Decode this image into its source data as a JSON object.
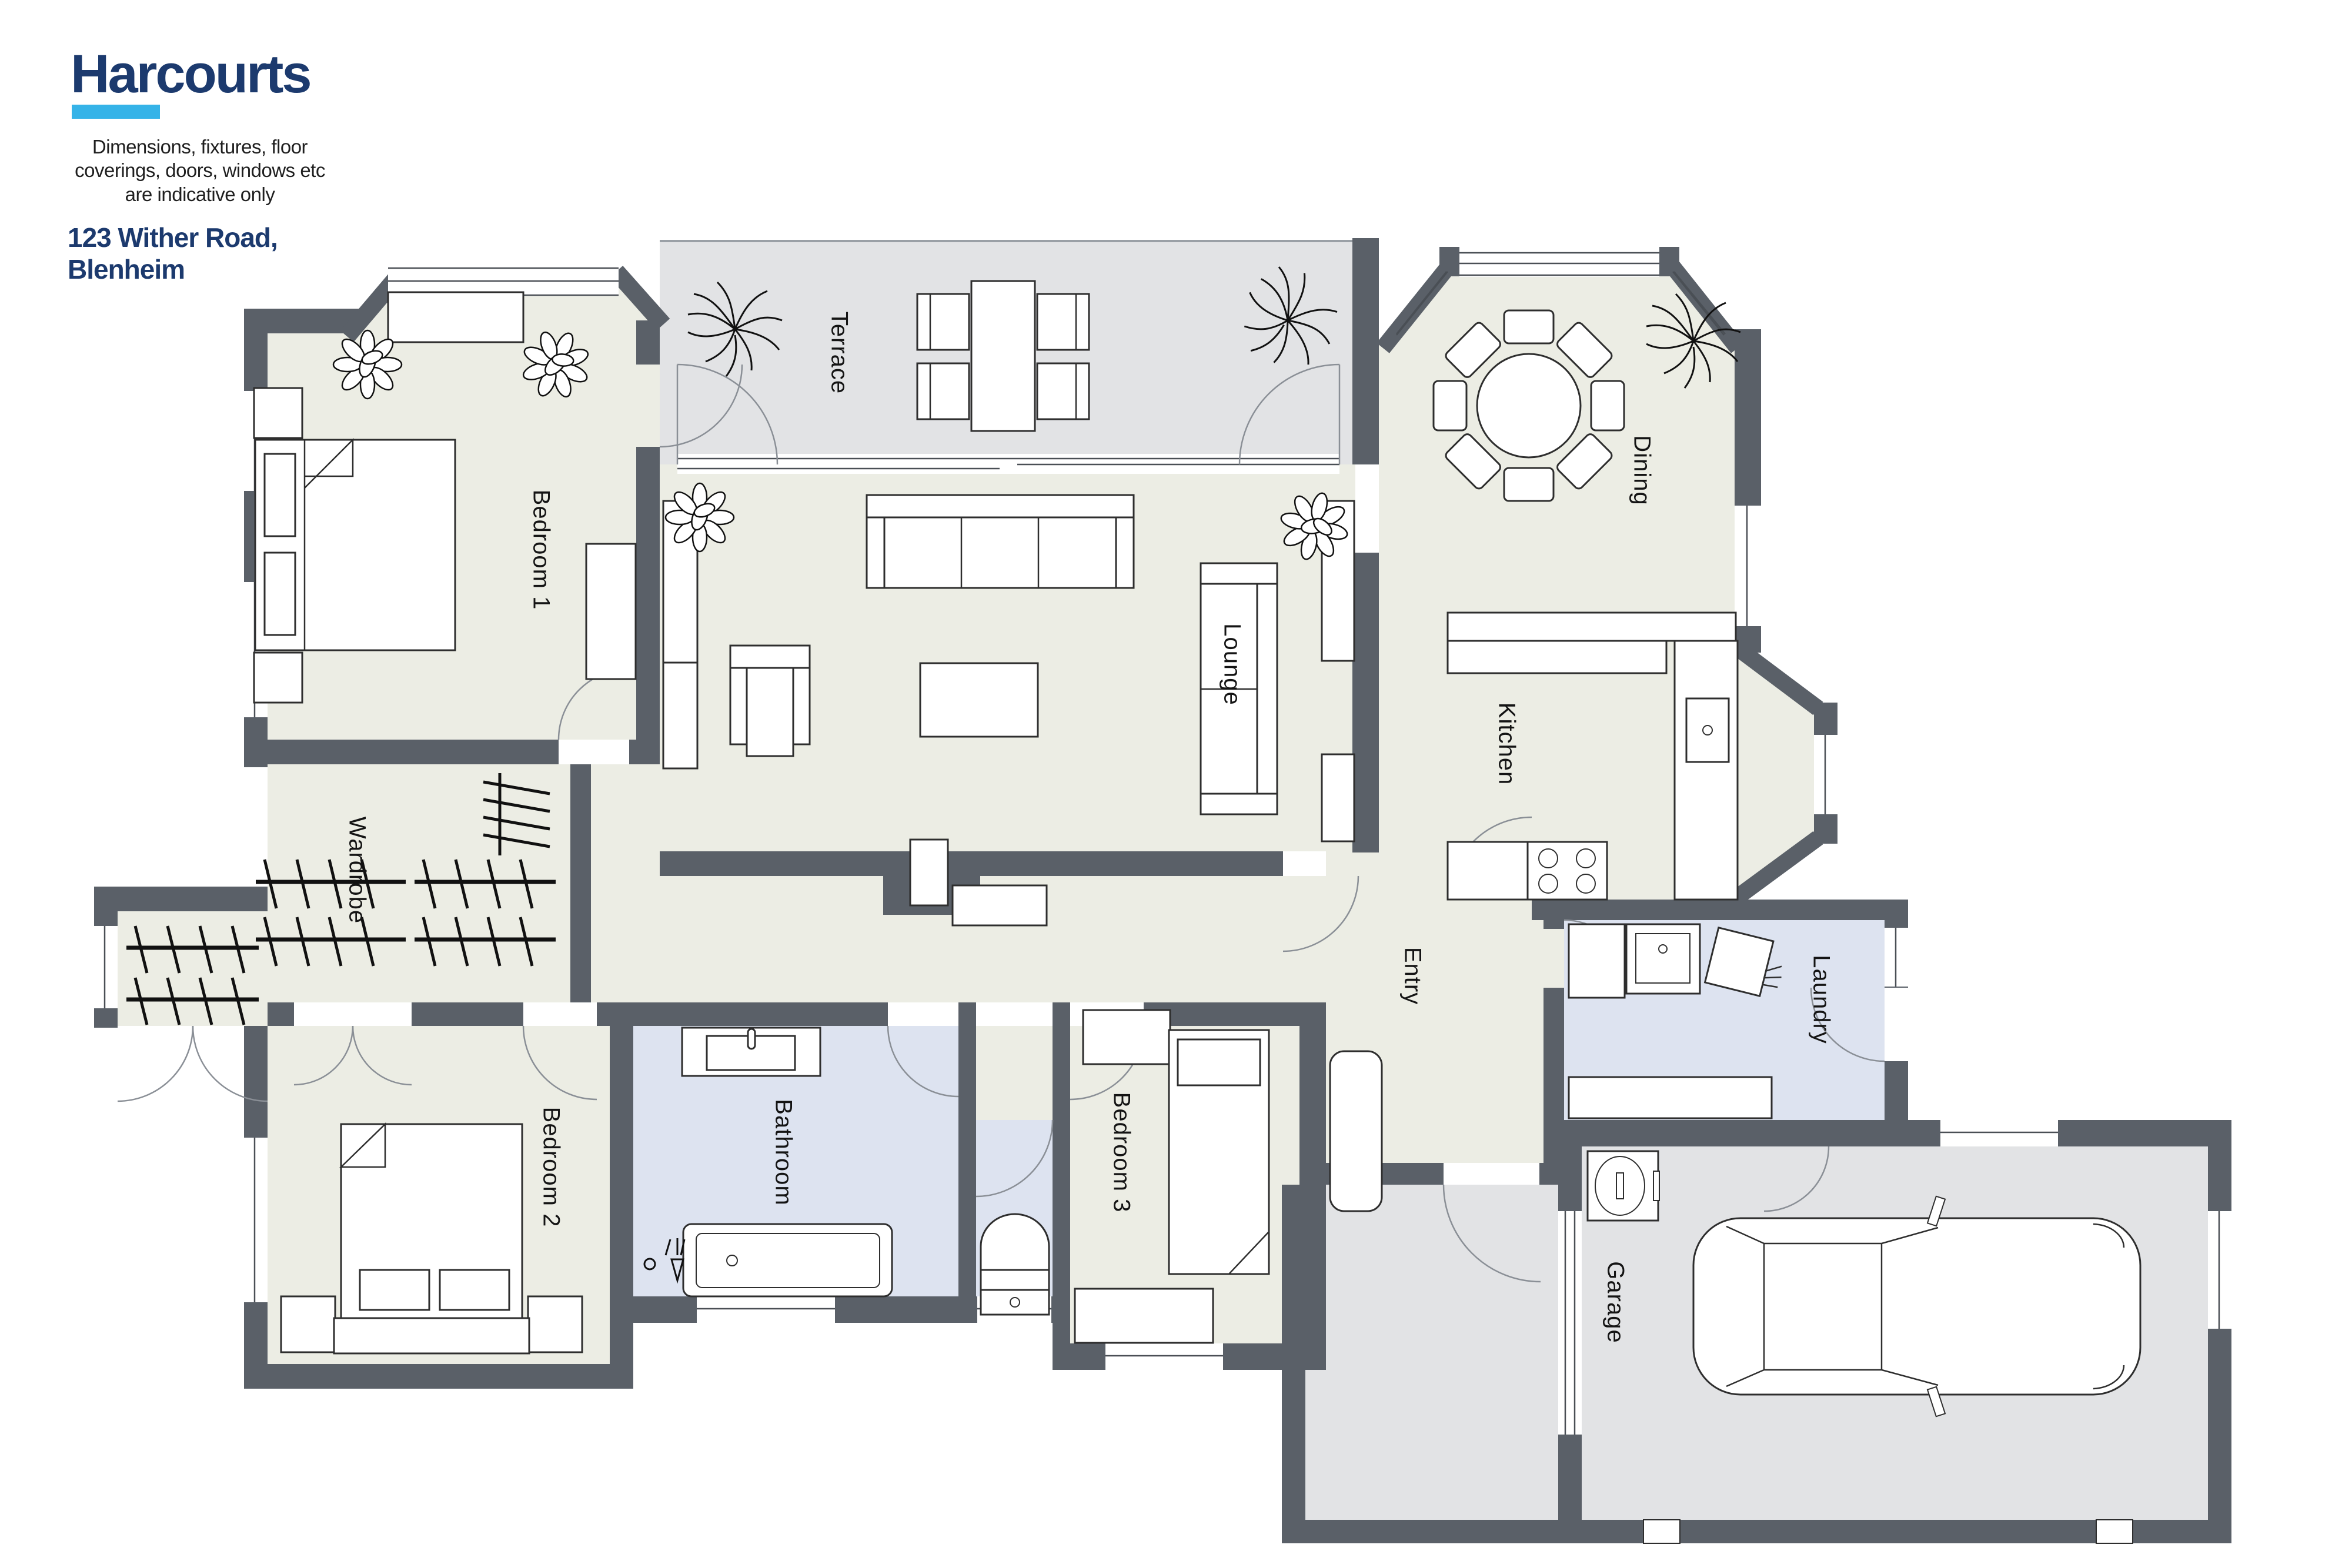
{
  "branding": {
    "logo_text": "Harcourts",
    "logo_color": "#1c3a6e",
    "accent_color": "#35b3e8",
    "disclaimer_lines": [
      "Dimensions, fixtures, floor",
      "coverings, doors, windows etc",
      "are indicative only"
    ],
    "address": "123 Wither Road, Blenheim"
  },
  "rooms": {
    "bedroom1": "Bedroom 1",
    "terrace": "Terrace",
    "lounge": "Lounge",
    "dining": "Dining",
    "kitchen": "Kitchen",
    "wardrobe": "Wardrobe",
    "laundry": "Laundry",
    "entry": "Entry",
    "bathroom": "Bathroom",
    "bedroom2": "Bedroom 2",
    "bedroom3": "Bedroom 3",
    "garage": "Garage"
  },
  "palette": {
    "wall": "#5a6068",
    "interior_floor": "#ecede4",
    "wet_floor": "#dde3f0",
    "outdoor_floor": "#e2e3e5",
    "furniture_line": "#2e2e2e"
  }
}
